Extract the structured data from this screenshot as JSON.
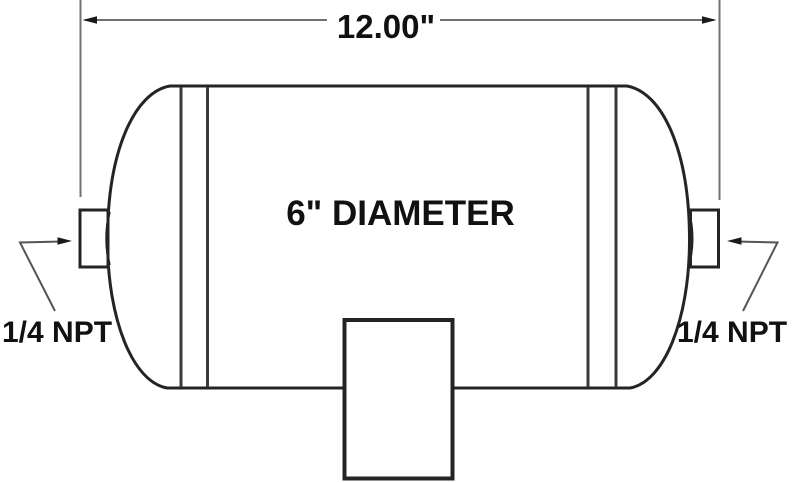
{
  "diagram": {
    "subject": "air-tank-technical-drawing",
    "labels": {
      "overall_length": "12.00\"",
      "diameter": "6\" DIAMETER",
      "port_left": "1/4 NPT",
      "port_right": "1/4 NPT"
    },
    "colors": {
      "background": "#ffffff",
      "outline": "#242424",
      "seam_line": "#3a3a3a",
      "dimension_line": "#707070",
      "leader_line": "#555555",
      "arrowhead": "#1a1a1a",
      "text": "#111111"
    }
  }
}
